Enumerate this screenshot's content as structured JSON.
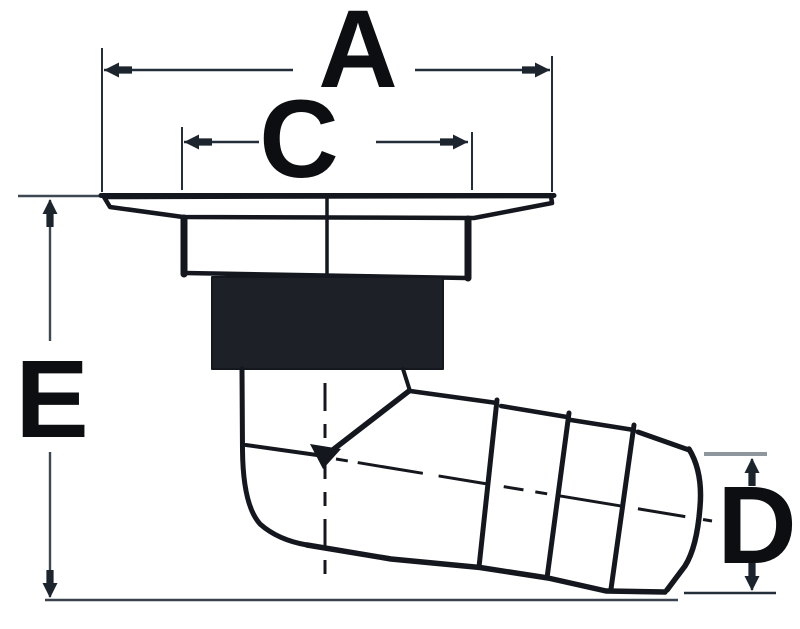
{
  "drawing": {
    "type": "technical-dimension-drawing",
    "subject": "flanged through-hull drain fitting with threaded body and angled hose barb outlet",
    "labels": {
      "a": "A",
      "c": "C",
      "d": "D",
      "e": "E"
    },
    "dimensions": [
      {
        "label": "A",
        "orientation": "horizontal",
        "extent": "full flange width, top of drawing"
      },
      {
        "label": "C",
        "orientation": "horizontal",
        "extent": "neck width under flange"
      },
      {
        "label": "D",
        "orientation": "vertical",
        "extent": "hose barb outlet diameter, right side"
      },
      {
        "label": "E",
        "orientation": "vertical",
        "extent": "overall height from flange top to barb bottom, left side"
      }
    ],
    "colors": {
      "ink": "#14181e",
      "thread_fill": "#1d2127",
      "dimension_line": "#242e3a",
      "secondary_line": "#3d4853",
      "light_extension_line": "#8f979e",
      "background": "#ffffff",
      "letter": "#0c0e11"
    }
  }
}
